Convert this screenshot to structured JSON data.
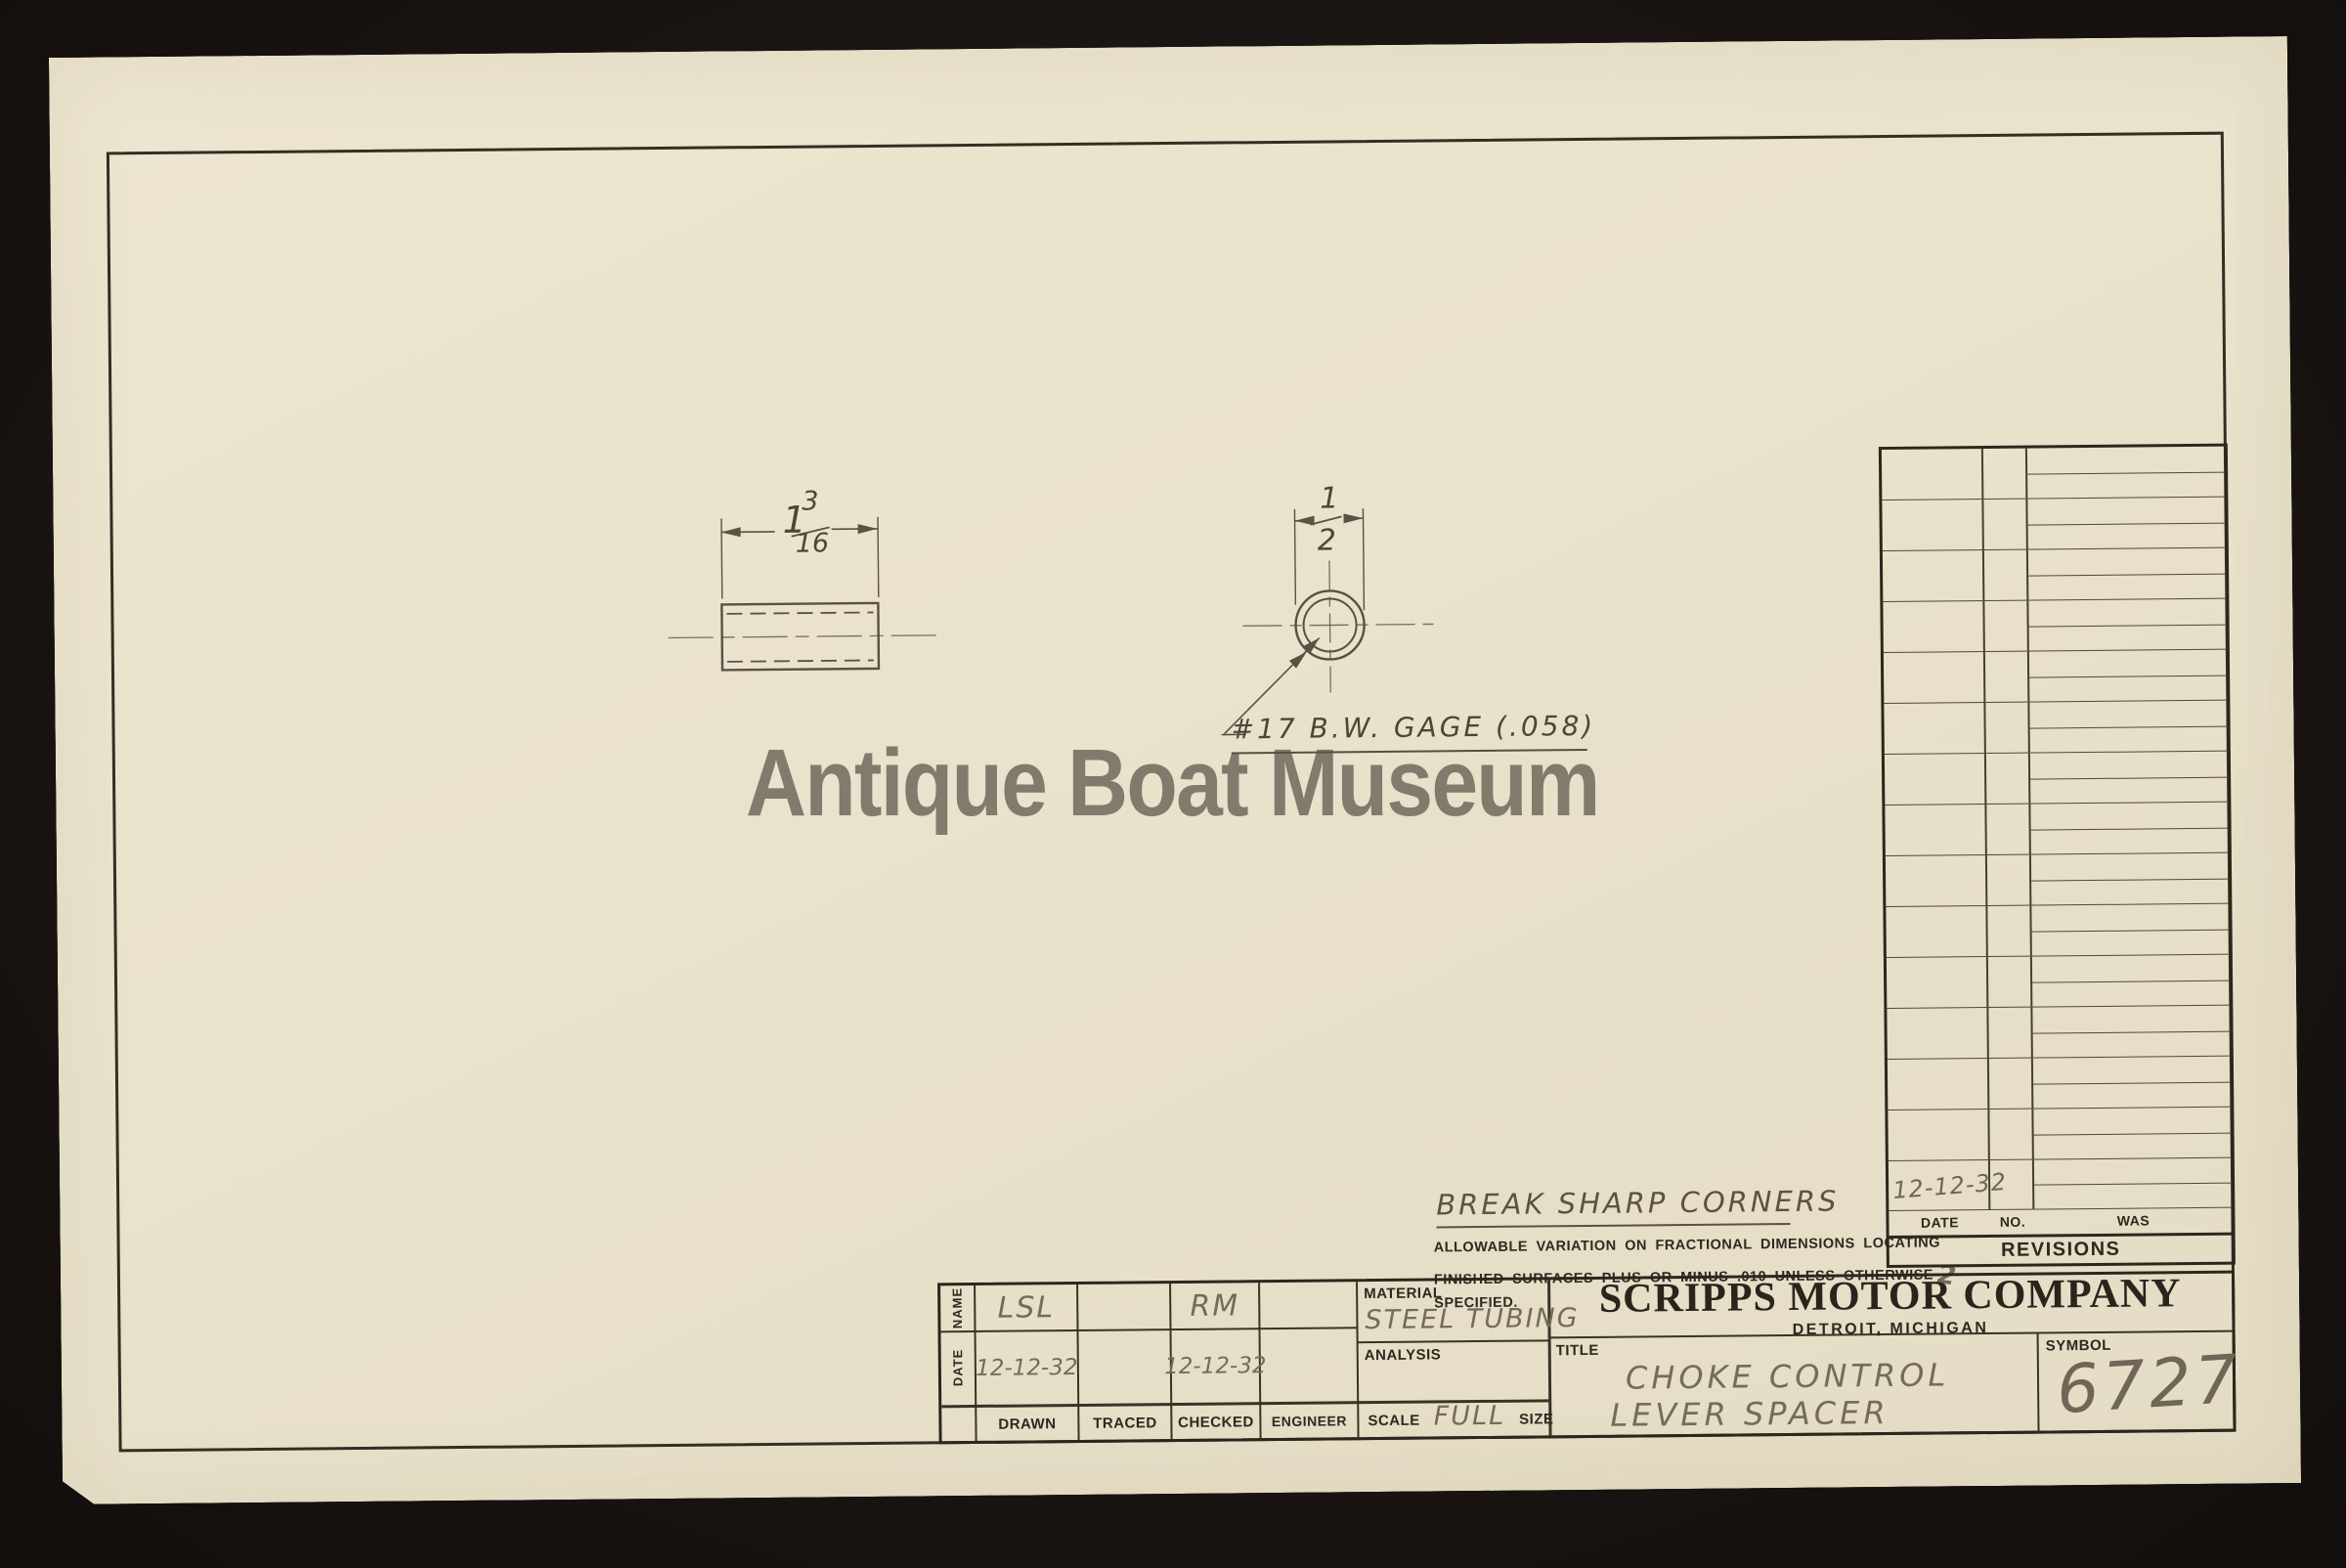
{
  "watermark": {
    "text": "Antique Boat Museum"
  },
  "drawing": {
    "side_view": {
      "length_whole": "1",
      "length_frac_num": "3",
      "length_frac_den": "16"
    },
    "end_view": {
      "od_frac_num": "1",
      "od_frac_den": "2",
      "wall_note": "#17 B.W. GAGE (.058)"
    }
  },
  "notes": {
    "break_corners": "BREAK SHARP CORNERS",
    "tolerance_line1": "ALLOWABLE VARIATION ON FRACTIONAL DIMENSIONS LOCATING",
    "tolerance_line2": "FINISHED SURFACES PLUS OR MINUS .010 UNLESS OTHERWISE",
    "tolerance_line3": "SPECIFIED.",
    "tolerance_annotation": "2"
  },
  "revisions": {
    "title": "REVISIONS",
    "columns": [
      "DATE",
      "NO.",
      "WAS"
    ],
    "empty_row_count": 14,
    "last_row_date": "12-12-32"
  },
  "title_block": {
    "name_row_label": "NAME",
    "date_row_label": "DATE",
    "columns": [
      {
        "label": "DRAWN",
        "name": "LSL",
        "date": "12-12-32"
      },
      {
        "label": "TRACED",
        "name": "",
        "date": ""
      },
      {
        "label": "CHECKED",
        "name": "RM",
        "date": "12-12-32"
      },
      {
        "label": "ENGINEER",
        "name": "",
        "date": ""
      }
    ],
    "material": {
      "label": "MATERIAL",
      "value": "STEEL TUBING"
    },
    "analysis": {
      "label": "ANALYSIS",
      "value": ""
    },
    "scale": {
      "label": "SCALE",
      "value": "FULL",
      "size_label": "SIZE"
    },
    "company": {
      "name": "SCRIPPS MOTOR COMPANY",
      "location": "DETROIT, MICHIGAN"
    },
    "title": {
      "label": "TITLE",
      "line1": "CHOKE CONTROL",
      "line2": "LEVER SPACER"
    },
    "symbol": {
      "label": "SYMBOL",
      "value": "6727"
    }
  },
  "colors": {
    "background": "#1b1513",
    "paper": "#e9e2cc",
    "printed_ink": "#2e2820",
    "pencil": "#746b5c",
    "drawing_line": "#5a5044",
    "watermark": "#6f6a5d"
  }
}
